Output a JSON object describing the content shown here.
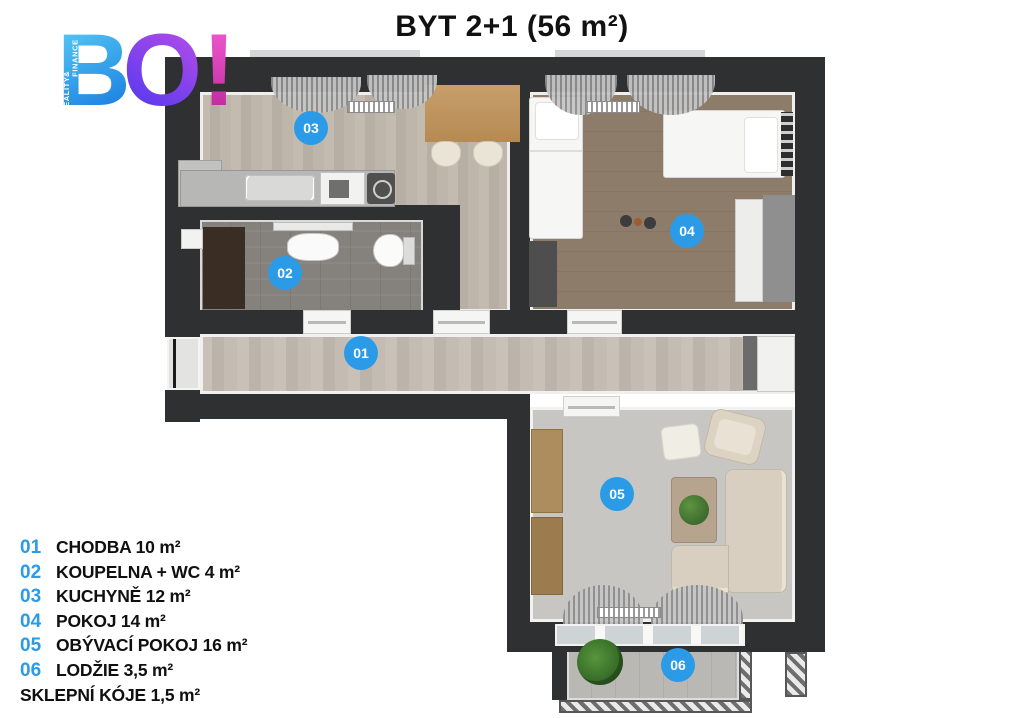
{
  "title": "BYT 2+1 (56 m²)",
  "logo": {
    "b": "B",
    "o": "O",
    "exclamation": "!",
    "tagline_line1": "REALITY",
    "tagline_line2": "& FINANCE"
  },
  "legend": {
    "items": [
      {
        "num": "01",
        "label": "CHODBA 10 m²"
      },
      {
        "num": "02",
        "label": "KOUPELNA + WC 4 m²"
      },
      {
        "num": "03",
        "label": "KUCHYNĚ 12 m²"
      },
      {
        "num": "04",
        "label": "POKOJ 14 m²"
      },
      {
        "num": "05",
        "label": "OBÝVACÍ POKOJ 16 m²"
      },
      {
        "num": "06",
        "label": "LODŽIE 3,5 m²"
      },
      {
        "num": "",
        "label": "SKLEPNÍ KÓJE 1,5 m²"
      }
    ]
  },
  "badges": {
    "b01": "01",
    "b02": "02",
    "b03": "03",
    "b04": "04",
    "b05": "05",
    "b06": "06"
  },
  "colors": {
    "accent_blue": "#2b9be8",
    "wall_dark": "#2f3032",
    "logo_blue": "#2ea8ec",
    "logo_purple": "#7b3bec",
    "logo_pink": "#d935b8"
  }
}
